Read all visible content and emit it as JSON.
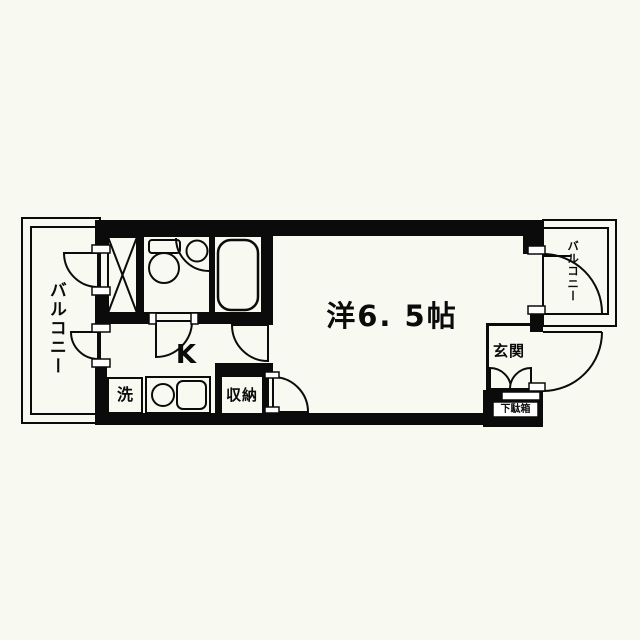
{
  "document": {
    "type": "apartment-floor-plan",
    "colors": {
      "background": "#f8faf2",
      "line": "#0b0b0b"
    }
  },
  "rooms": {
    "balcony_left": {
      "label": "バルコニー"
    },
    "balcony_right": {
      "label": "バルコニー"
    },
    "main_room": {
      "label": "洋6. 5帖"
    },
    "kitchen": {
      "label": "K"
    },
    "washer": {
      "label": "洗"
    },
    "storage": {
      "label": "収納"
    },
    "entrance": {
      "label": "玄関"
    },
    "shoe_cabinet": {
      "label": "下駄箱"
    }
  }
}
